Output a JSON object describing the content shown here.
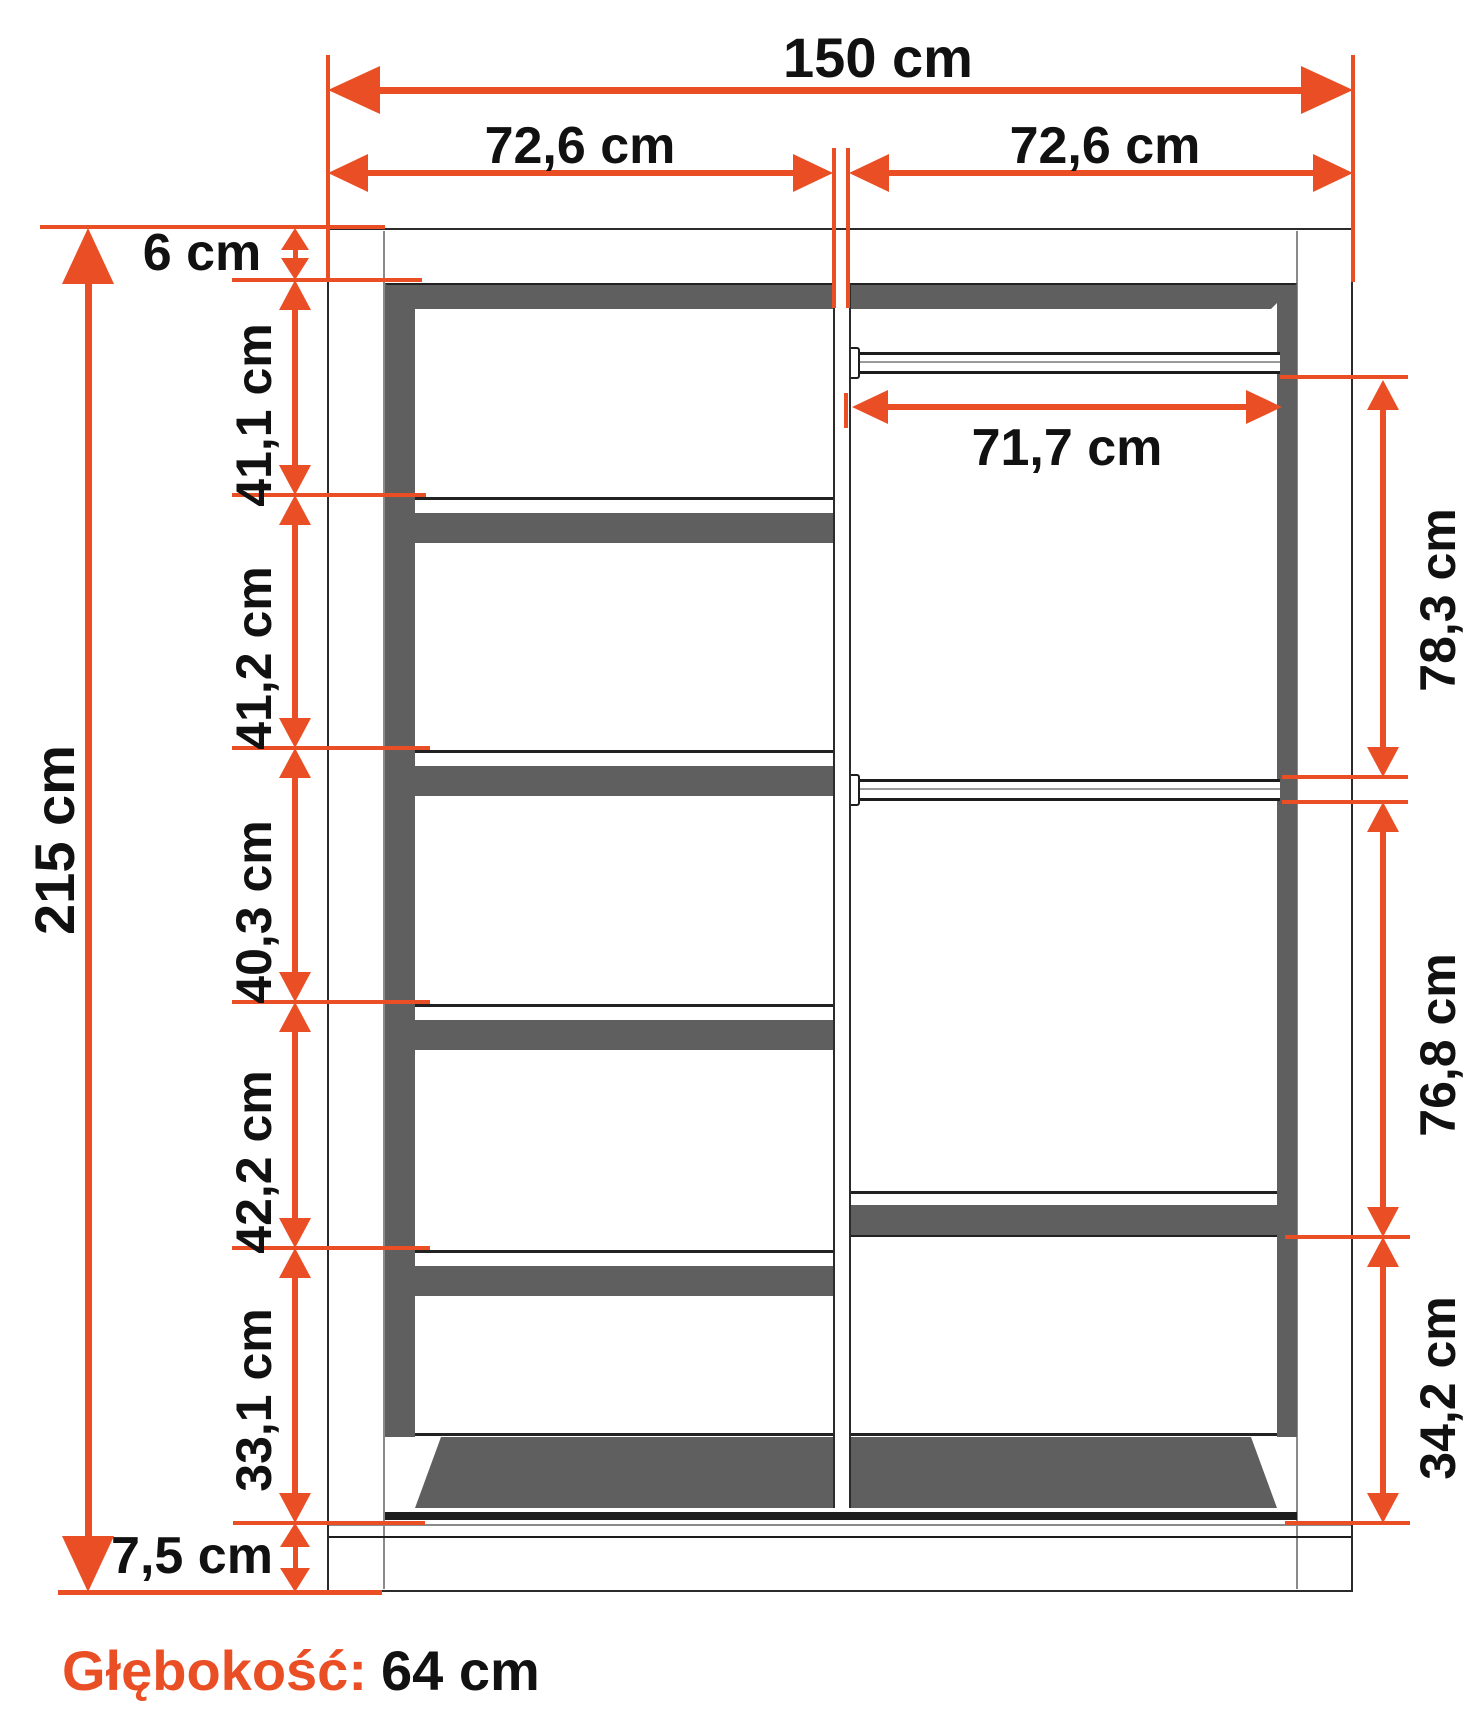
{
  "colors": {
    "accent": "#E94E24",
    "dark": "#5F5F5F",
    "line": "#2B2B2B",
    "text": "#111111"
  },
  "dimensions": {
    "total_width": "150 cm",
    "left_section_width": "72,6 cm",
    "right_section_width": "72,6 cm",
    "total_height": "215 cm",
    "top_panel": "6 cm",
    "left_compartment_1": "41,1 cm",
    "left_compartment_2": "41,2 cm",
    "left_compartment_3": "40,3 cm",
    "left_compartment_4": "42,2 cm",
    "left_compartment_5": "33,1 cm",
    "plinth": "7,5 cm",
    "rail_width": "71,7 cm",
    "right_compartment_top": "78,3 cm",
    "right_compartment_middle": "76,8 cm",
    "right_compartment_bottom": "34,2 cm"
  },
  "footer": {
    "depth_label": "Głębokość:",
    "depth_value": "64 cm"
  }
}
